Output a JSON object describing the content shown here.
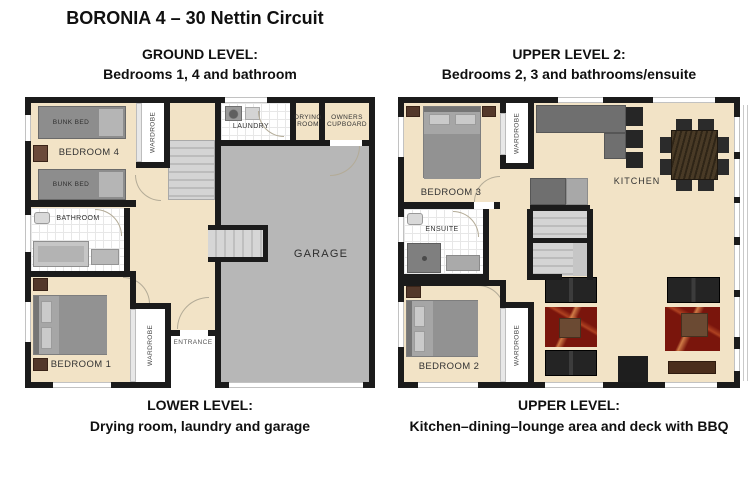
{
  "title": "BORONIA 4 – 30 Nettin Circuit",
  "shared": {
    "bunk_bed": "BUNK BED",
    "wardrobe": "WARDROBE"
  },
  "left": {
    "header": {
      "line1": "GROUND LEVEL:",
      "line2": "Bedrooms 1, 4 and bathroom"
    },
    "footer": {
      "line1": "LOWER LEVEL:",
      "line2": "Drying room, laundry and garage"
    },
    "rooms": {
      "bedroom4": "BEDROOM 4",
      "laundry": "LAUNDRY",
      "drying_room": "DRYING ROOM",
      "owners_cupboard": "OWNERS CUPBOARD",
      "bathroom": "BATHROOM",
      "garage": "GARAGE",
      "bedroom1": "BEDROOM 1",
      "entrance": "ENTRANCE"
    }
  },
  "right": {
    "header": {
      "line1": "UPPER LEVEL 2:",
      "line2": "Bedrooms 2, 3 and bathrooms/ensuite"
    },
    "footer": {
      "line1": "UPPER LEVEL:",
      "line2": "Kitchen–dining–lounge area and deck with BBQ"
    },
    "rooms": {
      "bedroom3": "BEDROOM 3",
      "kitchen": "KITCHEN",
      "ensuite": "ENSUITE",
      "bedroom2": "BEDROOM 2"
    }
  },
  "colors": {
    "floor_beige": "#f2e3c6",
    "garage_gray": "#b7b7b7",
    "wall_black": "#1b1b1b",
    "tile_white": "#ffffff",
    "stairs_gray": "#c9c9c9",
    "counter_gray": "#6f6f6f",
    "appliance_black": "#262626",
    "dining_table_wood": "#3f3222",
    "sofa_black": "#242424",
    "rug_red": "#7a150c",
    "coffee_table_brown": "#6b4a33",
    "tv_unit_brown": "#4a2e1c",
    "bed_gray": "#a6a6a6",
    "nightstand_brown": "#53382a"
  }
}
